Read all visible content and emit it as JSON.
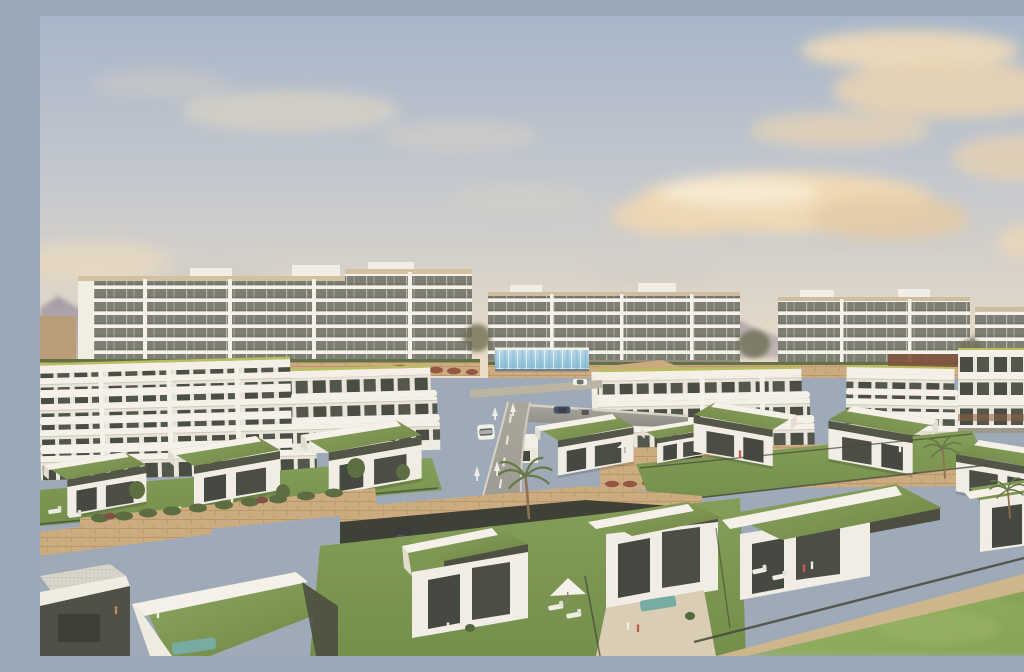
{
  "meta": {
    "title": "Aerial architectural render of a hillside residential resort development",
    "description": "Photorealistic CGI render: rows of modern single-storey villas with planted green roofs and gardens in the foreground, stepped white mid-rise apartment terraces behind them, large white apartment blocks on the skyline, a curving asphalt access road with cars, stone retaining walls, palm trees, tiny human figures, and a hazy warm evening sky with cream clouds over distant mountains.",
    "visible_text": "none"
  },
  "scene": {
    "sky": {
      "description": "Soft slate-blue sky warming to cream at the horizon",
      "clouds": [
        "large cream cloud band centre",
        "cloud mass upper right",
        "faint wisps upper left",
        "low wisp left edge",
        "small cloud right edge",
        "grey haze wisps above rooflines"
      ]
    },
    "background": {
      "mountains": [
        "purple-grey peak far left",
        "hazy ridge centre behind blocks",
        "hazy ridge and treeline far right"
      ],
      "apartment_blocks": [
        {
          "name": "block-a-west-wing",
          "floors": 7
        },
        {
          "name": "block-a-east-wing",
          "floors": 7
        },
        {
          "name": "block-b-centre",
          "floors": 5
        },
        {
          "name": "block-c-right",
          "floors": 6
        },
        {
          "name": "block-d-far-right",
          "floors": 5
        }
      ],
      "far_left_building": "low tan building at horizon"
    },
    "midground": {
      "terraced_midrises": [
        "left stepped complex with lime roof trim",
        "centre complex",
        "right complex",
        "far-right complex with rust louvre band"
      ],
      "pool_glass_wall": "long light-blue glass balustrade of an infinity pool below block B",
      "stone_retaining_walls": "tan dry-stone terracing with hedges and rust-red shrubs"
    },
    "road": {
      "description": "Asphalt road descending from a T-junction at centre toward bottom left",
      "markings": [
        "dashed white centre line",
        "four white direction arrows",
        "white crossing bars",
        "right-hand spur with parked cars"
      ],
      "vehicles": [
        {
          "name": "white-car-moving",
          "color_key": "car_white"
        },
        {
          "name": "parked-car-blue",
          "color_key": "car_blue"
        },
        {
          "name": "parked-car-grey",
          "color_key": "car_silver"
        },
        {
          "name": "terrace-car-white",
          "color_key": "car_white"
        },
        {
          "name": "silver-coupe-driveway",
          "color_key": "car_silver"
        },
        {
          "name": "dark-hatchback-driveway",
          "color_key": "suv_dark"
        },
        {
          "name": "dark-suv-driveway",
          "color_key": "suv_dark"
        }
      ]
    },
    "villas": {
      "count": 14,
      "style": "white cubic volumes, dark olive fascia, planted sedum/grass roofs with white L-shaped parapets, full-height dark glazing, private lawns with dark mesh fences",
      "rows": [
        "back row right of road (5)",
        "left mid row (3)",
        "foreground row (6)"
      ]
    },
    "landscape": {
      "palm_trees": 4,
      "shrub_trees": "dark olive garden trees and hedge rows",
      "people": "approximately 15 tiny figures on lawns and terraces",
      "furniture": [
        "white sun loungers",
        "white parasol centre foreground",
        "small parasols on terraces",
        "teal outdoor sofas"
      ],
      "bottom_right": "bright blurred communal lawn crossed by a beige stone footpath and dark fence"
    }
  },
  "colors": {
    "sky_top": "#a3b4ca",
    "sky_mid": "#c2c7d0",
    "sky_horizon": "#ecdfcd",
    "cloud_cream": "#f0d9b4",
    "cloud_highlight": "#f7ead1",
    "cloud_grey": "#cbc9c6",
    "mountain_haze": "#9c94a5",
    "facade_white": "#f6f3ec",
    "facade_glazing": "#767a6e",
    "roof_fascia_tan": "#cfc0a0",
    "accent_lime": "#b6bd5a",
    "roof_dark_olive": "#4b4f41",
    "green_roof": "#79934e",
    "lawn": "#7a9850",
    "lawn_bright": "#8aab58",
    "hedge": "#5c6a3f",
    "shrub_rust": "#8f4f3c",
    "stone_wall": "#c9a87c",
    "road_asphalt": "#8f9089",
    "road_marking": "#f0ede6",
    "path_beige": "#cdb48a",
    "glass_pool_blue": "#9fd0e6",
    "car_white": "#f2f2ef",
    "car_blue": "#3a4a66",
    "car_silver": "#b9bdc2",
    "suv_dark": "#26292e",
    "window_dark": "#3c403a",
    "palm_green": "#5d7342",
    "gravel_roof": "#d7d4cb",
    "terrace_paving": "#d9cdb6"
  }
}
